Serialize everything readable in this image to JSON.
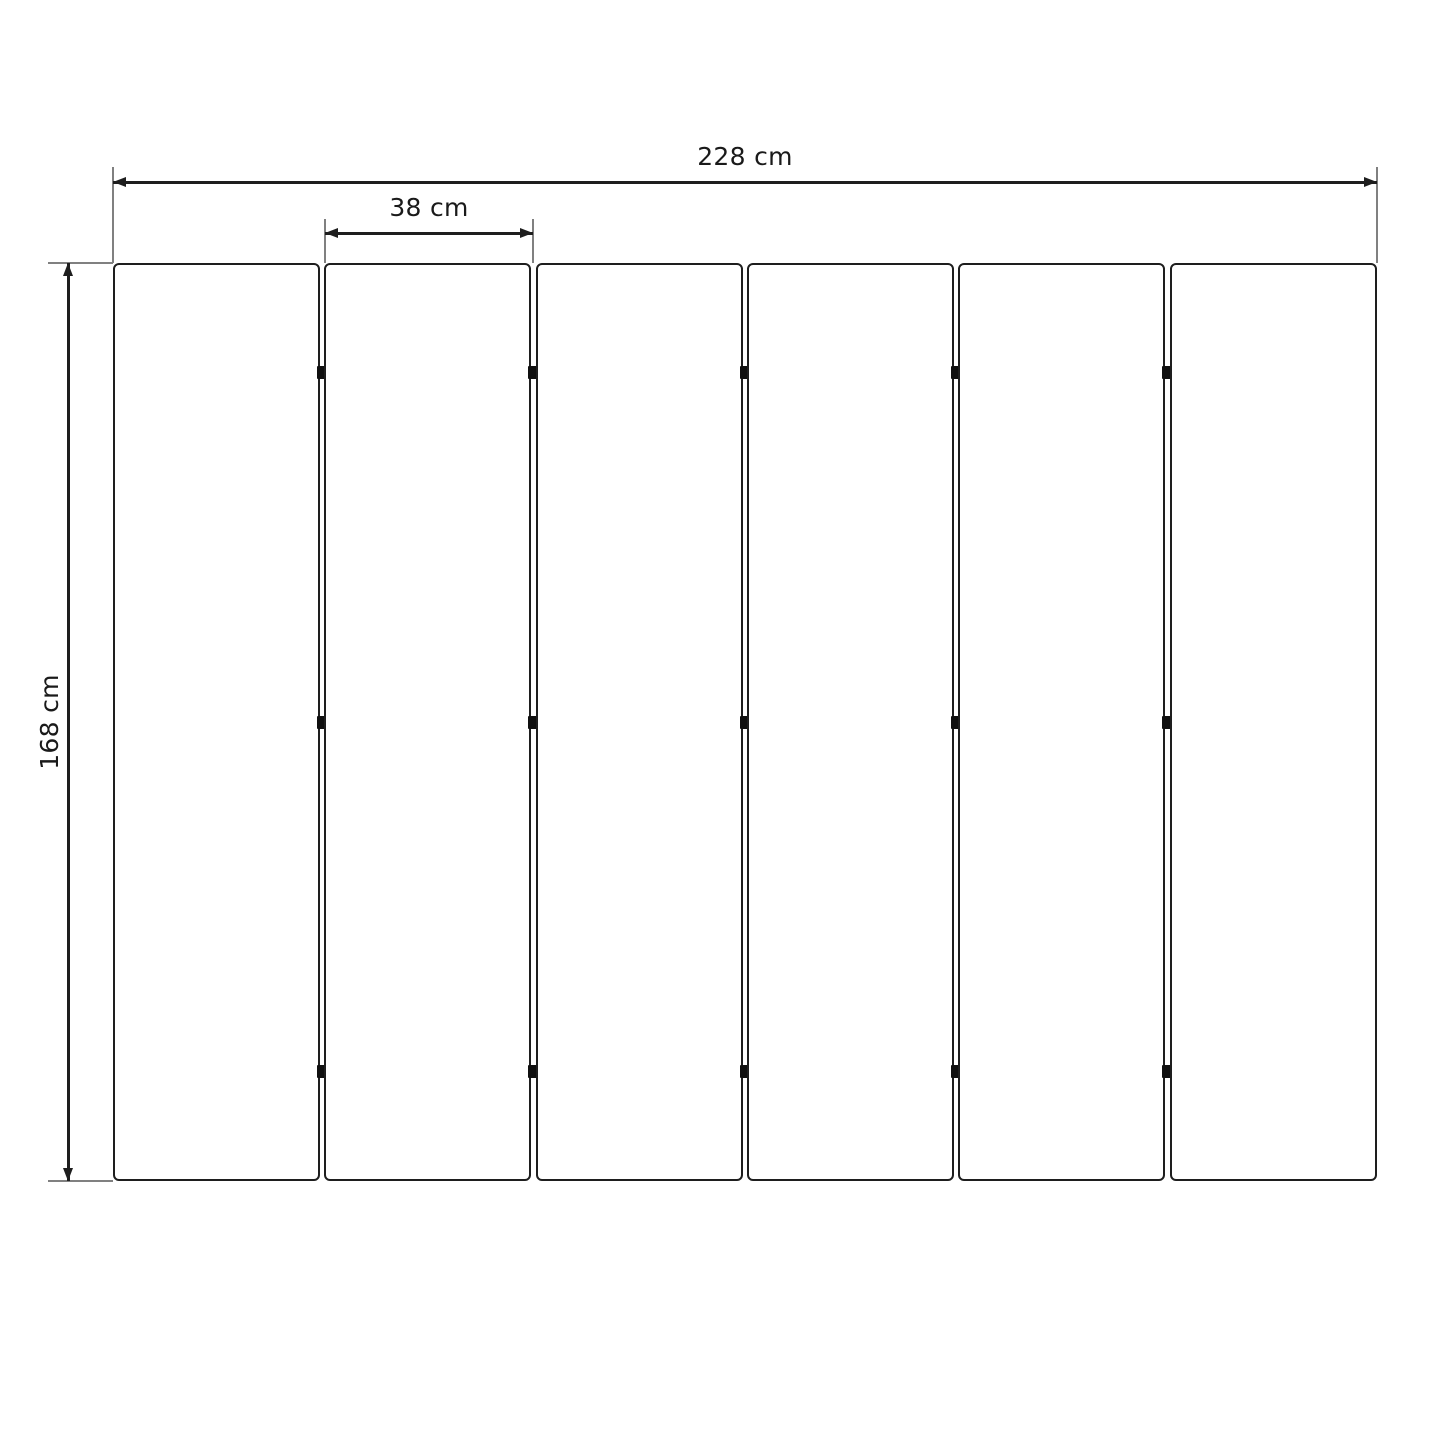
{
  "diagram": {
    "type": "dimension-drawing",
    "subject": "six-panel folding screen, front view",
    "unit": "cm",
    "panel_count": 6,
    "hinge_rows_per_gap": 3,
    "dimensions": {
      "total_width": {
        "label": "228 cm",
        "value_cm": 228
      },
      "panel_width": {
        "label": "38 cm",
        "value_cm": 38
      },
      "height": {
        "label": "168 cm",
        "value_cm": 168
      }
    },
    "colors": {
      "line": "#1e1e1e",
      "extension": "#808080",
      "hinge": "#101010",
      "text": "#1a1a1a",
      "background": "#ffffff"
    }
  }
}
